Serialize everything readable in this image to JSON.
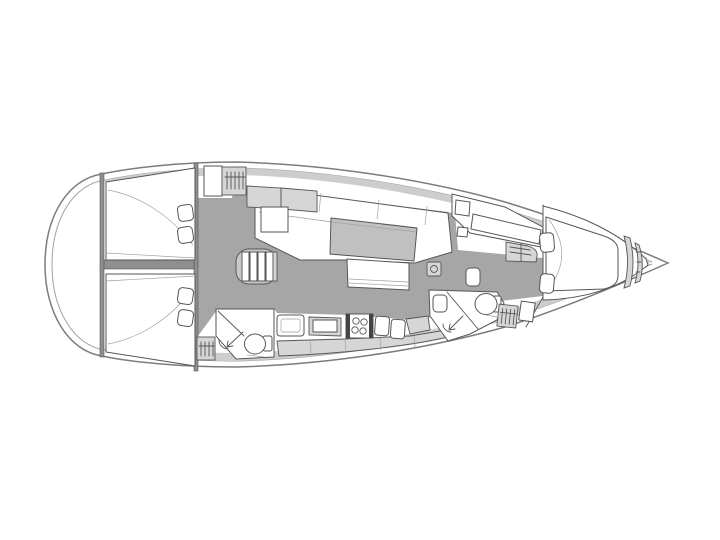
{
  "meta": {
    "type": "sailing-yacht interior floor plan",
    "view": "top-down",
    "bow_direction": "right",
    "visible_text": ""
  },
  "colors": {
    "background": "#ffffff",
    "hull_line": "#7c7c7c",
    "hull_line2": "#a0a0a0",
    "deck_band": "#cdcdcd",
    "floor": "#a6a6a6",
    "wall": "#8f8f8f",
    "outline": "#565656",
    "white_fill": "#ffffff",
    "light_fill": "#d6d6d6",
    "table_fill": "#c0c0c0",
    "steps_fill": "#c9c9c9",
    "dark": "#444444"
  },
  "areas": [
    {
      "id": "hull",
      "label": "Yacht hull, bow pointing right"
    },
    {
      "id": "aft-cabin-port",
      "label": "Aft double cabin port side with berth and two pillows"
    },
    {
      "id": "aft-cabin-starboard",
      "label": "Aft double cabin starboard side with berth and two pillows"
    },
    {
      "id": "companionway",
      "label": "Companionway steps"
    },
    {
      "id": "salon",
      "label": "Salon with U-shaped settee, saloon table and bench"
    },
    {
      "id": "galley",
      "label": "Galley with fridge lid, two-burner stove and twin sinks"
    },
    {
      "id": "aft-head",
      "label": "Aft head with shower, toilet and hanging locker"
    },
    {
      "id": "forward-head",
      "label": "Forward head with sink, shower, toilet and hanging locker"
    },
    {
      "id": "nav-station",
      "label": "Navigation station with chart table and seat"
    },
    {
      "id": "forward-cabin",
      "label": "Forward owner cabin with island berth and two pillows"
    },
    {
      "id": "bow-locker",
      "label": "Bow shelves and anchor locker"
    }
  ]
}
